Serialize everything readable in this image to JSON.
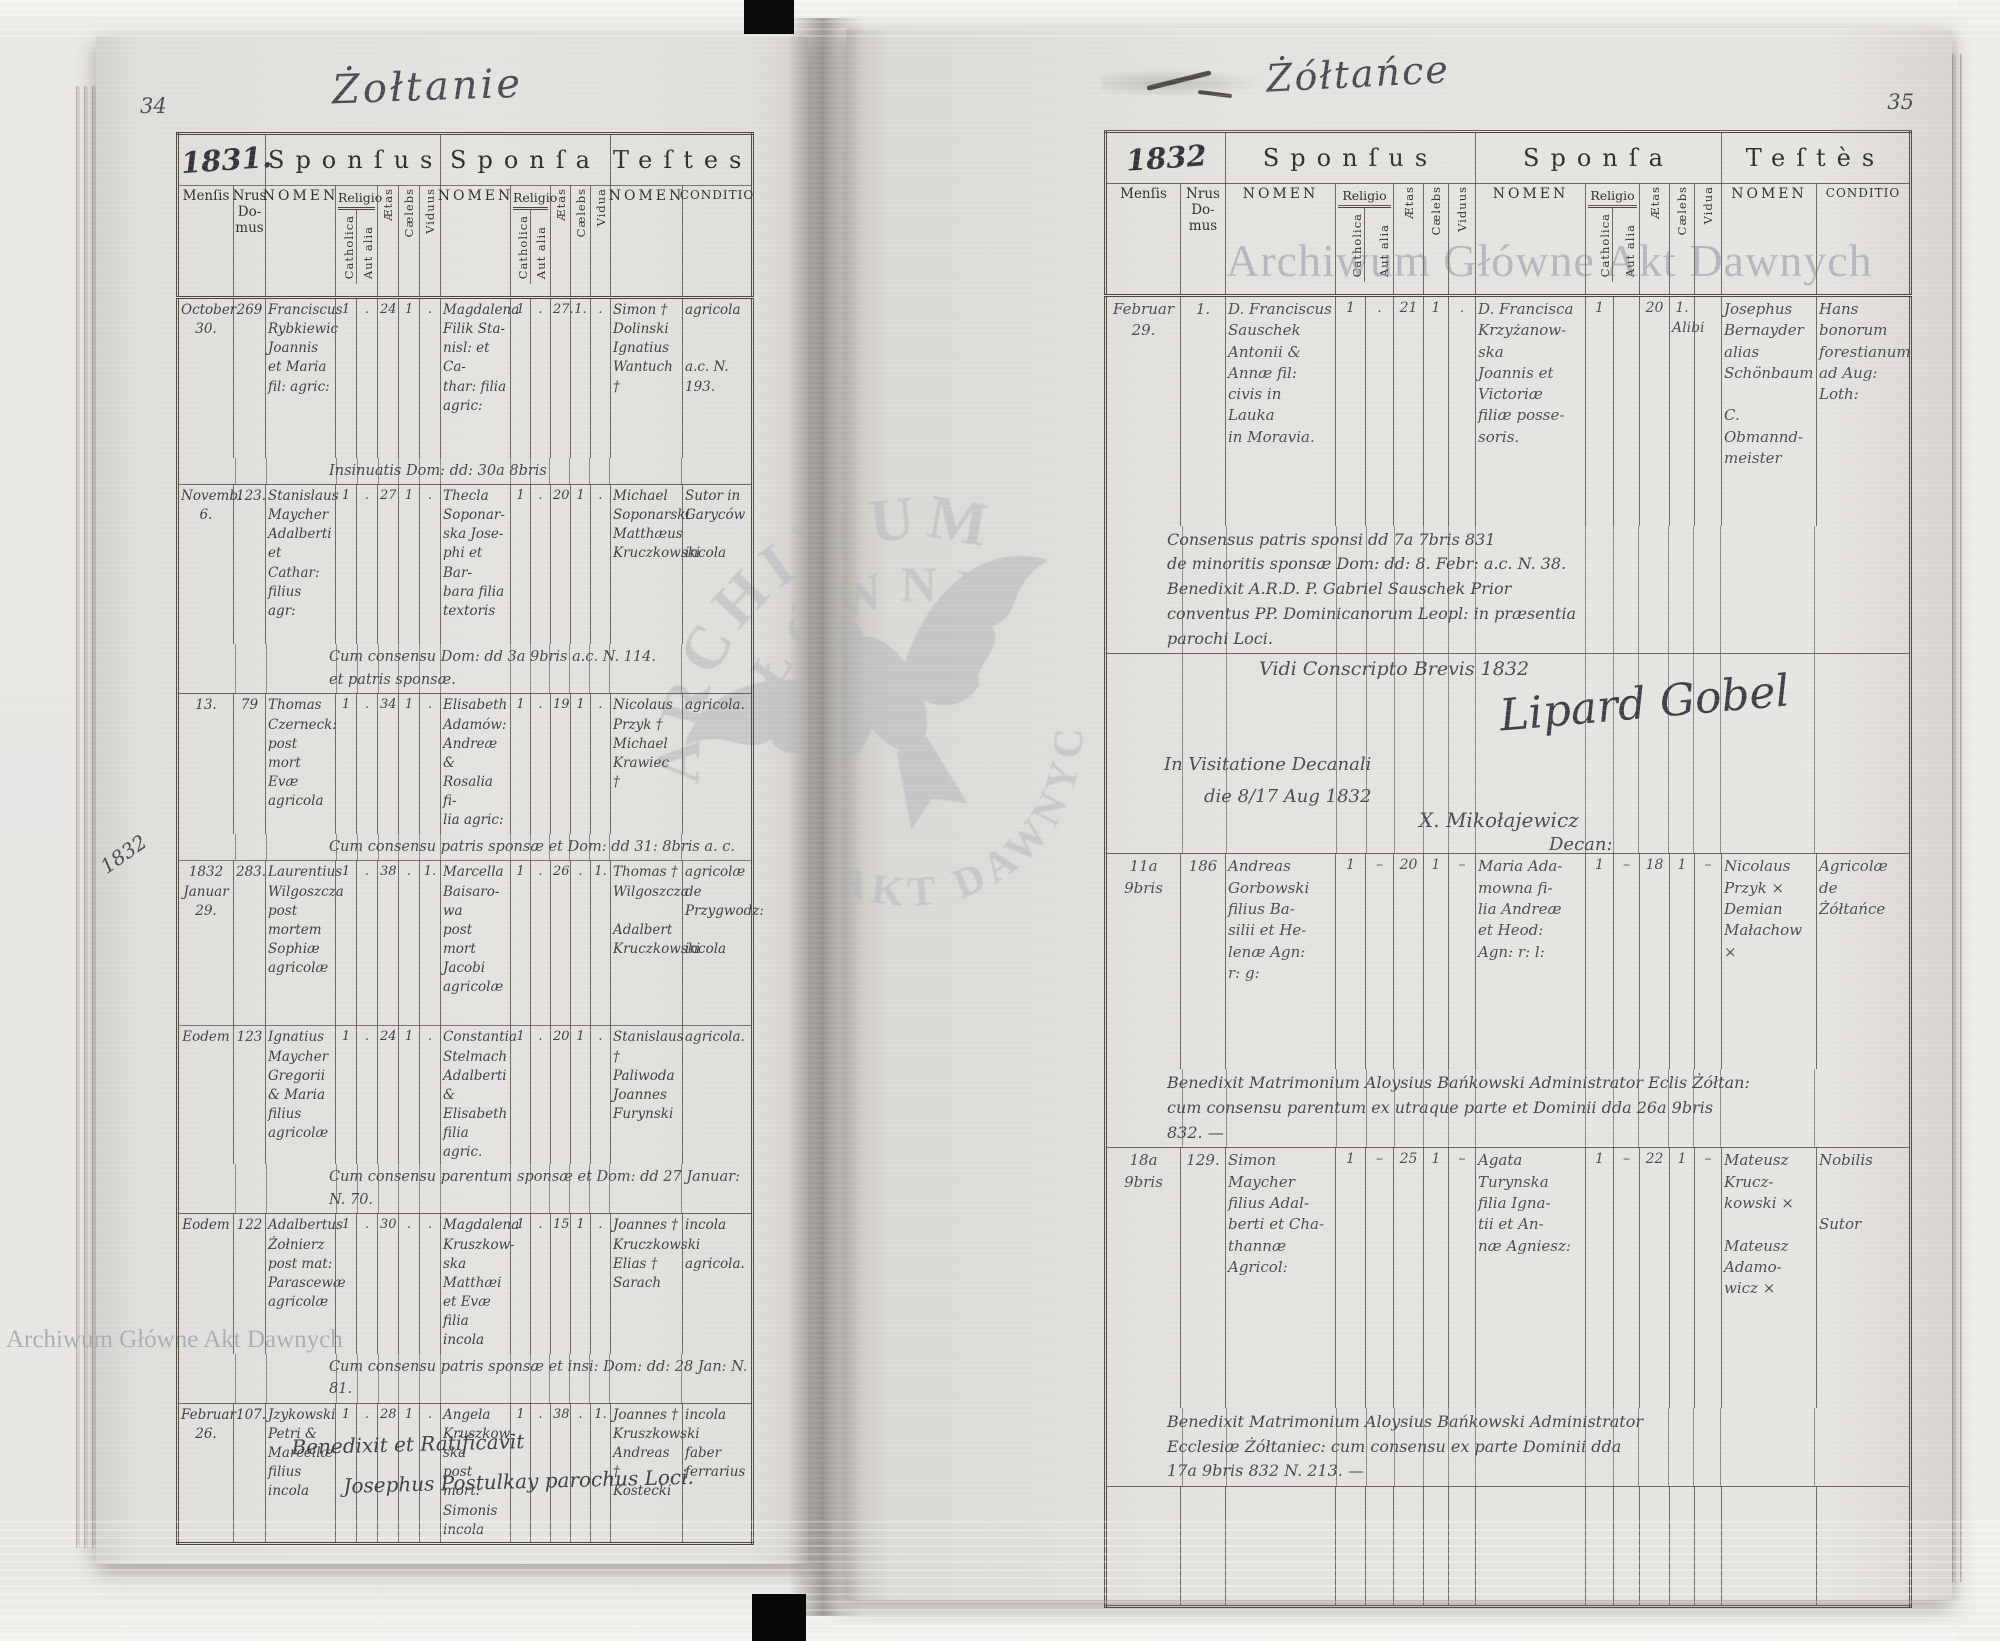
{
  "doc": {
    "archive_watermark": "Archiwum Główne Akt Dawnych",
    "table_headers": {
      "sponsus": "Sponſus",
      "sponsa": "Sponſa",
      "testes_left": "Teſtes",
      "testes_right": "Teſtès",
      "mensis": "Menſis",
      "nrus": "Nrus\nDo-\nmus",
      "nomen": "NOMEN",
      "religio": "Religio",
      "catholica": "Catholica",
      "aut_alia": "Aut alia",
      "aetas": "Ætas",
      "caelebs": "Cælebs",
      "viduus": "Viduus",
      "vidua": "Vidua",
      "conditio": "CONDITIO"
    }
  },
  "watermark": {
    "arc1": "ARCHIWUM",
    "arc2": "GŁÓWNE",
    "arc3": "AKT DAWNYCH"
  },
  "pages": [
    {
      "side": "left",
      "page_number": "34",
      "title": "Żołtanie",
      "year": "1831.",
      "margin_year": "1832",
      "footer": "Benedixit et Ratificavit\n        Josephus Postulkay parochus Loci.",
      "entries": [
        {
          "rh": 160,
          "m": "October\n30.",
          "d": "269",
          "s_nomen": "Franciscus\nRybkiewic\nJoannis\net Maria\nfil: agric:",
          "s_c": "1",
          "s_a": ".",
          "s_ae": "24",
          "s_cb": "1",
          "s_vd": ".",
          "p_nomen": "Magdalena\nFilik Sta-\nnisl: et Ca-\nthar: filia\nagric:",
          "p_c": "1",
          "p_a": ".",
          "p_ae": "27.",
          "p_cb": "1.",
          "p_vd": ".",
          "t_nomen": "Simon †\nDolinski\nIgnatius\nWantuch †",
          "cond": "agricola\n\n\na.c. N. 193.",
          "note": "Insinuatis Dom: dd: 30a 8bris"
        },
        {
          "rh": 160,
          "m": "Novemb.\n6.",
          "d": "123.",
          "s_nomen": "Stanislaus\nMaycher\nAdalberti\net Cathar:\nfilius agr:",
          "s_c": "1",
          "s_a": ".",
          "s_ae": "27",
          "s_cb": "1",
          "s_vd": ".",
          "p_nomen": "Thecla\nSoponar-\nska Jose-\nphi et Bar-\nbara filia\ntextoris",
          "p_c": "1",
          "p_a": ".",
          "p_ae": "20",
          "p_cb": "1",
          "p_vd": ".",
          "t_nomen": "Michael\nSoponarski\nMatthæus\nKruczkowski",
          "cond": "Sutor in\nGaryców\n\nincola",
          "note": "Cum consensu Dom: dd 3a 9bris a.c. N. 114.\net patris sponsæ."
        },
        {
          "rh": 140,
          "m": "13.",
          "d": "79",
          "s_nomen": "Thomas\nCzerneck:\npost mort\nEvæ\nagricola",
          "s_c": "1",
          "s_a": ".",
          "s_ae": "34",
          "s_cb": "1",
          "s_vd": ".",
          "p_nomen": "Elisabeth\nAdamów:\nAndreæ &\nRosalia fi-\nlia agric:",
          "p_c": "1",
          "p_a": ".",
          "p_ae": "19",
          "p_cb": "1",
          "p_vd": ".",
          "t_nomen": "Nicolaus\nPrzyk †\nMichael\nKrawiec †",
          "cond": "agricola.",
          "note": "Cum consensu patris sponsæ et Dom: dd 31: 8bris a. c."
        },
        {
          "rh": 165,
          "m": "1832\nJanuar\n29.",
          "d": "283.",
          "s_nomen": "Laurentius\nWilgoszcza\npost\nmortem\nSophiæ\nagricolæ",
          "s_c": "1",
          "s_a": ".",
          "s_ae": "38",
          "s_cb": ".",
          "s_vd": "1.",
          "p_nomen": "Marcella\nBaisaro-\nwa\npost mort\nJacobi\nagricolæ",
          "p_c": "1",
          "p_a": ".",
          "p_ae": "26",
          "p_cb": ".",
          "p_vd": "1.",
          "t_nomen": "Thomas †\nWilgoszcza\n\nAdalbert\nKruczkowski",
          "cond": "agricolæ de\nPrzygwodz:\n\nincola"
        },
        {
          "rh": 105,
          "m": "Eodem",
          "d": "123",
          "s_nomen": "Ignatius\nMaycher\nGregorii\n& Maria\nfilius\nagricolæ",
          "s_c": "1",
          "s_a": ".",
          "s_ae": "24",
          "s_cb": "1",
          "s_vd": ".",
          "p_nomen": "Constantia\nStelmach\nAdalberti\n& Elisabeth\nfilia agric.",
          "p_c": "1",
          "p_a": ".",
          "p_ae": "20",
          "p_cb": "1",
          "p_vd": ".",
          "t_nomen": "Stanislaus †\nPaliwoda\nJoannes\nFurynski",
          "cond": "agricola.",
          "note": "Cum consensu parentum sponsæ et Dom: dd 27 Januar: N. 70."
        },
        {
          "rh": 140,
          "m": "Eodem",
          "d": "122",
          "s_nomen": "Adalbertus\nŻołnierz\npost mat:\nParascewæ\nagricolæ",
          "s_c": "1",
          "s_a": ".",
          "s_ae": "30",
          "s_cb": ".",
          "s_vd": ".",
          "p_nomen": "Magdalena\nKruszkow-\nska\nMatthæi\net Evæ\nfilia incola",
          "p_c": "1",
          "p_a": ".",
          "p_ae": "15",
          "p_cb": "1",
          "p_vd": ".",
          "t_nomen": "Joannes †\nKruczkowski\nElias †\nSarach",
          "cond": "incola\n\nagricola.",
          "note": "Cum consensu patris sponsæ et insi: Dom: dd: 28 Jan: N. 81."
        },
        {
          "rh": 135,
          "m": "Februar\n26.",
          "d": "107.",
          "s_nomen": "Jzykowski\nPetri &\nMarcellæ\nfilius\nincola",
          "s_c": "1",
          "s_a": ".",
          "s_ae": "28",
          "s_cb": "1",
          "s_vd": ".",
          "p_nomen": "Angela\nKruszkow-\nska\npost mort:\nSimonis\nincola",
          "p_c": "1",
          "p_a": ".",
          "p_ae": "38",
          "p_cb": ".",
          "p_vd": "1.",
          "t_nomen": "Joannes †\nKruszkowski\nAndreas †\nKostecki",
          "cond": "incola\n\nfaber\nferrarius"
        }
      ]
    },
    {
      "side": "right",
      "page_number": "35",
      "title": "Żółtańce",
      "year": "1832",
      "visitation": {
        "line1": "Vidi Conscripto Brevis 1832",
        "signature": "Lipard Gobel",
        "line2": "In Visitatione Decanali",
        "line3": "die 8/17 Aug 1832",
        "line4": "X. Mikołajewicz",
        "line5": "Decan:"
      },
      "entries": [
        {
          "rh": 230,
          "m": "Februar\n29.",
          "d": "1.",
          "s_nomen": "D. Franciscus\nSauschek\nAntonii &\nAnnæ fil:\ncivis in\nLauka\nin Moravia.",
          "s_c": "1",
          "s_a": ".",
          "s_ae": "21",
          "s_cb": "1",
          "s_vd": ".",
          "p_nomen": "D. Francisca\nKrzyżanow-\nska\nJoannis et\nVictoriæ\nfiliæ posse-\nsoris.",
          "p_c": "1",
          "p_a": "",
          "p_ae": "20",
          "p_cb": "1.\nAlibi",
          "p_vd": "",
          "t_nomen": "Josephus\nBernayder\nalias Schönbaum\n\nC. Obmannd-\nmeister",
          "cond": "Hans\nbonorum\nforestianum\nad Aug:\nLoth:",
          "note": "Consensus patris sponsi dd 7a 7bris 831\nde minoritis sponsæ Dom: dd: 8. Febr: a.c. N. 38.\nBenedixit A.R.D. P. Gabriel Sauschek Prior\nconventus PP. Dominicanorum Leopl: in præsentia\nparochi Loci."
        },
        {
          "rh": 215,
          "m": "11a\n9bris",
          "d": "186",
          "s_nomen": "Andreas\nGorbowski\nfilius Ba-\nsilii et He-\nlenæ Agn:\nr: g:",
          "s_c": "1",
          "s_a": "–",
          "s_ae": "20",
          "s_cb": "1",
          "s_vd": "–",
          "p_nomen": "Maria Ada-\nmowna fi-\nlia Andreæ\net Heod:\nAgn: r: l:",
          "p_c": "1",
          "p_a": "–",
          "p_ae": "18",
          "p_cb": "1",
          "p_vd": "–",
          "t_nomen": "Nicolaus\nPrzyk ×\nDemian\nMałachow ×",
          "cond": "Agricolæ\nde\nŻółtańce",
          "note": "Benedixit Matrimonium Aloysius Bańkowski Administrator Eclis Żółtan:\ncum consensu parentum ex utraque parte et Dominii dda 26a 9bris\n832. —"
        },
        {
          "rh": 260,
          "m": "18a\n9bris",
          "d": "129.",
          "s_nomen": "Simon\nMaycher\nfilius Adal-\nberti et Cha-\nthannæ\nAgricol:",
          "s_c": "1",
          "s_a": "–",
          "s_ae": "25",
          "s_cb": "1",
          "s_vd": "–",
          "p_nomen": "Agata\nTurynska\nfilia Igna-\ntii et An-\nnæ Agniesz:",
          "p_c": "1",
          "p_a": "–",
          "p_ae": "22",
          "p_cb": "1",
          "p_vd": "–",
          "t_nomen": "Mateusz\nKrucz-\nkowski ×\n\nMateusz\nAdamo-\nwicz ×",
          "cond": "Nobilis\n\n\nSutor",
          "note": "Benedixit Matrimonium Aloysius Bańkowski Administrator\nEcclesiæ Żółtaniec: cum consensu ex parte Dominii dda\n17a 9bris 832 N. 213. —"
        }
      ]
    }
  ]
}
